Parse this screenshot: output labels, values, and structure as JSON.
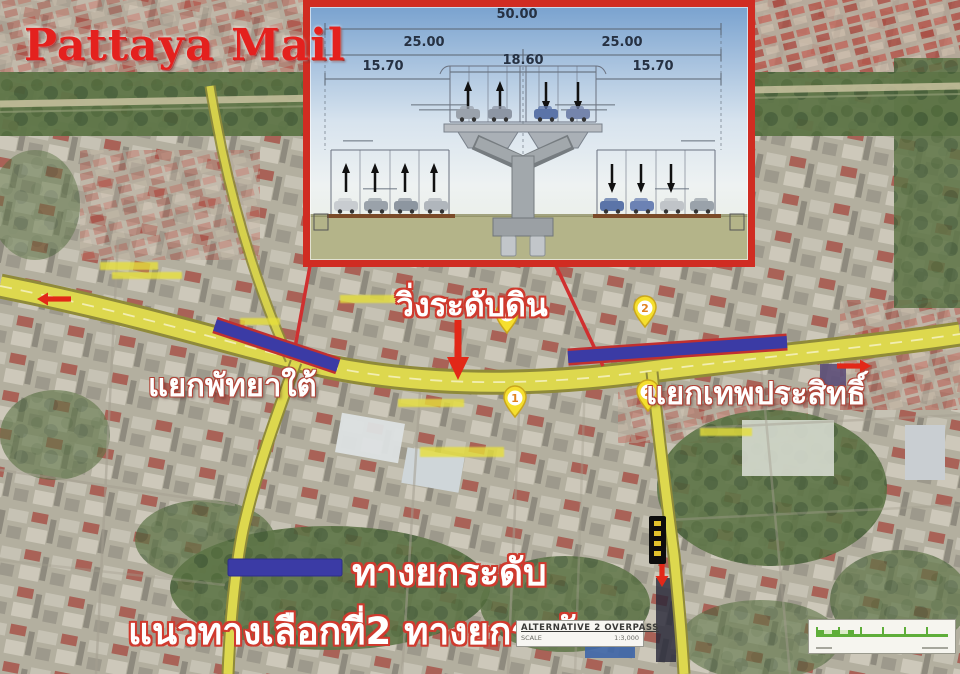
{
  "masthead": {
    "title": "Pattaya Mail"
  },
  "inset": {
    "name": "overpass-cross-section-drawing",
    "dimensions": {
      "total_width": "50.00",
      "left_half": "25.00",
      "right_half": "25.00",
      "deck_width": "18.60",
      "left_frontage": "15.70",
      "right_frontage": "15.70"
    }
  },
  "map": {
    "labels": {
      "ground_level": "วิ่งระดับดิน",
      "south_pattaya_junction": "แยกพัทยาใต้",
      "thepprasit_junction": "แยกเทพประสิทธิ์"
    },
    "markers": [
      {
        "label": "1"
      },
      {
        "label": "2"
      },
      {
        "label": "1"
      },
      {
        "label": "2"
      }
    ]
  },
  "legend": {
    "elevated_label": "ทางยกระดับ",
    "caption": "แนวทางเลือกที่2 ทางยกระดับ"
  },
  "title_block": {
    "title": "ALTERNATIVE 2 OVERPASS",
    "scale_label": "SCALE",
    "scale_value": "1:3,000"
  },
  "colors": {
    "masthead_red": "#e4211e",
    "overlay_blue": "#3b3ba5",
    "overlay_bar_outline": "#c03030",
    "road_yellow": "#ddd84e",
    "marker_yellow": "#f5df2e",
    "inset_border_red": "#d02c22",
    "scalebar_green": "#5fae3a"
  }
}
